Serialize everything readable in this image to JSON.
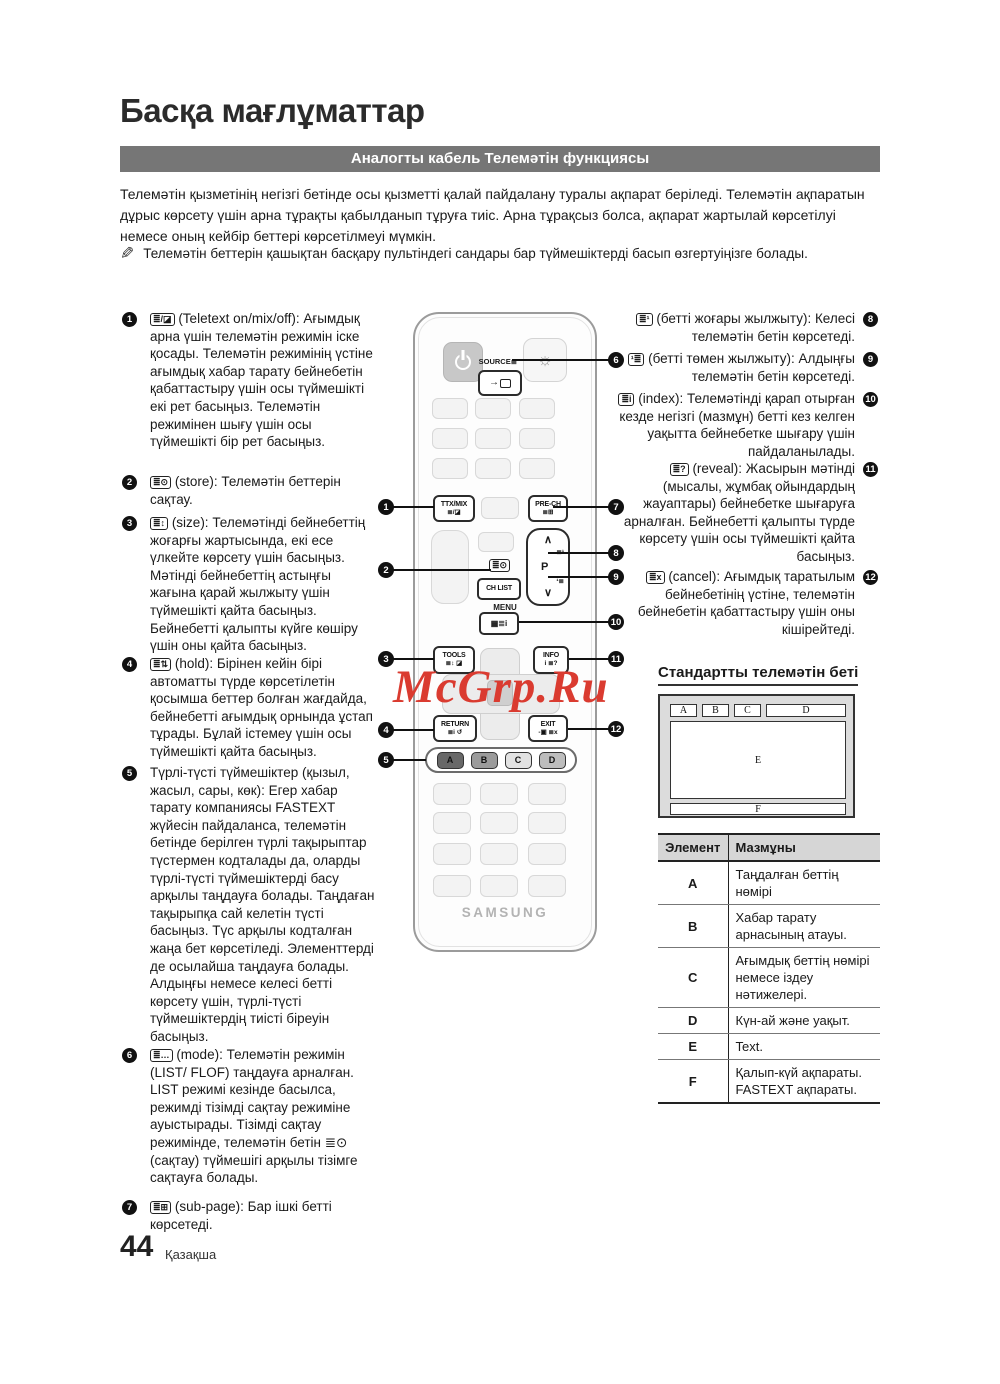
{
  "page": {
    "title": "Басқа мағлұматтар",
    "section_header": "Аналогты кабель Телемәтін функциясы",
    "intro": "Телемәтін қызметінің негізгі бетінде осы қызметті қалай пайдалану туралы ақпарат беріледі. Телемәтін ақпаратын дұрыс көрсету үшін арна тұрақты қабылданып тұруға тиіс. Арна тұрақсыз болса, ақпарат жартылай көрсетілуі немесе оның кейбір беттері көрсетілмеуі мүмкін.",
    "note": "Телемәтін беттерін қашықтан басқару пультіндегі сандары бар түймешіктерді басып өзгертуіңізге болады.",
    "page_number": "44",
    "language": "Қазақша",
    "watermark": "McGrp.Ru",
    "colors": {
      "header_bar": "#767676",
      "watermark_red": "#da3b30",
      "callout": "#111111"
    }
  },
  "left_items": [
    {
      "num": "1",
      "icon": "≣/◪",
      "text": "(Teletext on/mix/off): Ағымдық арна үшін телемәтін режимін іске қосады. Телемәтін режимінің үстіне ағымдық хабар тарату бейнебетін қабаттастыру үшін осы түймешікті екі рет басыңыз. Телемәтін режимінен шығу үшін осы түймешікті бір рет басыңыз."
    },
    {
      "num": "2",
      "icon": "≣⊙",
      "text": "(store): Телемәтін беттерін сақтау."
    },
    {
      "num": "3",
      "icon": "≣↕",
      "text": "(size): Телемәтінді бейнебеттің жоғарғы жартысында, екі есе үлкейте көрсету үшін басыңыз. Мәтінді бейнебеттің астыңғы жағына қарай жылжыту үшін түймешікті қайта басыңыз. Бейнебетті қалыпты күйге көшіру үшін оны қайта басыңыз."
    },
    {
      "num": "4",
      "icon": "≣⇅",
      "text": "(hold): Бірінен кейін бірі автоматты түрде көрсетілетін қосымша беттер болған жағдайда, бейнебетті ағымдық орнында ұстап тұрады. Бұлай істемеу үшін осы түймешікті қайта басыңыз."
    },
    {
      "num": "5",
      "icon": "",
      "text": "Түрлі-түсті түймешіктер (қызыл, жасыл, сары, көк): Егер хабар тарату компаниясы FASTEXT жүйесін пайдаланса, телемәтін бетінде берілген түрлі тақырыптар түстермен кодталады да, оларды түрлі-түсті түймешіктерді басу арқылы таңдауға болады. Таңдаған тақырыпқа сай келетін түсті басыңыз. Түс арқылы кодталған жаңа бет көрсетіледі. Элементтерді де осылайша таңдауға болады. Алдыңғы немесе келесі бетті көрсету үшін, түрлі-түсті түймешіктердің тиісті біреуін басыңыз."
    },
    {
      "num": "6",
      "icon": "≣…",
      "text": "(mode): Телемәтін режимін (LIST/ FLOF) таңдауға арналған. LIST режимі кезінде басылса, режимді тізімді сақтау режиміне ауыстырады. Тізімді сақтау режимінде, телемәтін бетін ≣⊙ (сақтау) түймешігі арқылы тізімге сақтауға болады."
    },
    {
      "num": "7",
      "icon": "≣⊞",
      "text": "(sub-page): Бар ішкі бетті көрсетеді."
    }
  ],
  "right_items": [
    {
      "num": "8",
      "icon": "≣¹",
      "text": "(бетті жоғары жылжыту): Келесі телемәтін бетін көрсетеді."
    },
    {
      "num": "9",
      "icon": "¹≣",
      "text": "(бетті төмен жылжыту): Алдыңғы телемәтін бетін көрсетеді."
    },
    {
      "num": "10",
      "icon": "≣i",
      "text": "(index): Телемәтінді қарап отырған кезде негізгі (мазмұн) бетті кез келген уақытта бейнебетке шығару үшін пайдаланылады."
    },
    {
      "num": "11",
      "icon": "≣?",
      "text": "(reveal): Жасырын мәтінді (мысалы, жұмбақ ойындардың жауаптары) бейнебетке шығаруға арналған. Бейнебетті қалыпты түрде көрсету үшін осы түймешікті қайта басыңыз."
    },
    {
      "num": "12",
      "icon": "≣x",
      "text": "(cancel): Ағымдық таратылым бейнебетінің үстіне, телемәтін бейнебетін қабаттастыру үшін оны кішірейтеді."
    }
  ],
  "remote": {
    "brand": "SAMSUNG",
    "source_label": "SOURCE≣",
    "buttons": {
      "ttx_mix": "TTX/MIX",
      "ttx_mix_icons": "≣/◪",
      "pre_ch": "PRE-CH",
      "pre_ch_icons": "≣⊞",
      "ch_list": "CH LIST",
      "menu": "MENU",
      "menu_icons": "▦≣i",
      "tools": "TOOLS",
      "tools_icons": "≣↕ ◪",
      "info": "INFO",
      "info_icons": "i ≣?",
      "return": "RETURN",
      "return_icons": "≣i ↺",
      "exit": "EXIT",
      "exit_icons": "-▣ ≣x",
      "p": "P",
      "p_up": "∧",
      "p_down": "∨",
      "p_up_icon": "≣¹",
      "p_down_icon": "¹≣",
      "store_icon": "≣⊙",
      "sun_icon": "☼",
      "color_a": "A",
      "color_b": "B",
      "color_c": "C",
      "color_d": "D"
    },
    "callouts": [
      "1",
      "2",
      "3",
      "4",
      "5",
      "6",
      "7",
      "8",
      "9",
      "10",
      "11",
      "12"
    ]
  },
  "standard_page": {
    "title": "Стандартты телемәтін беті",
    "labels": {
      "a": "A",
      "b": "B",
      "c": "C",
      "d": "D",
      "e": "E",
      "f": "F"
    }
  },
  "table": {
    "headers": [
      "Элемент",
      "Мазмұны"
    ],
    "rows": [
      {
        "element": "A",
        "content": "Таңдалған беттің нөмірі"
      },
      {
        "element": "B",
        "content": "Хабар тарату арнасының атауы."
      },
      {
        "element": "C",
        "content": "Ағымдық беттің нөмірі немесе іздеу нәтижелері."
      },
      {
        "element": "D",
        "content": "Күн-ай және уақыт."
      },
      {
        "element": "E",
        "content": "Text."
      },
      {
        "element": "F",
        "content": "Қалып-күй ақпараты. FASTEXT ақпараты."
      }
    ]
  }
}
